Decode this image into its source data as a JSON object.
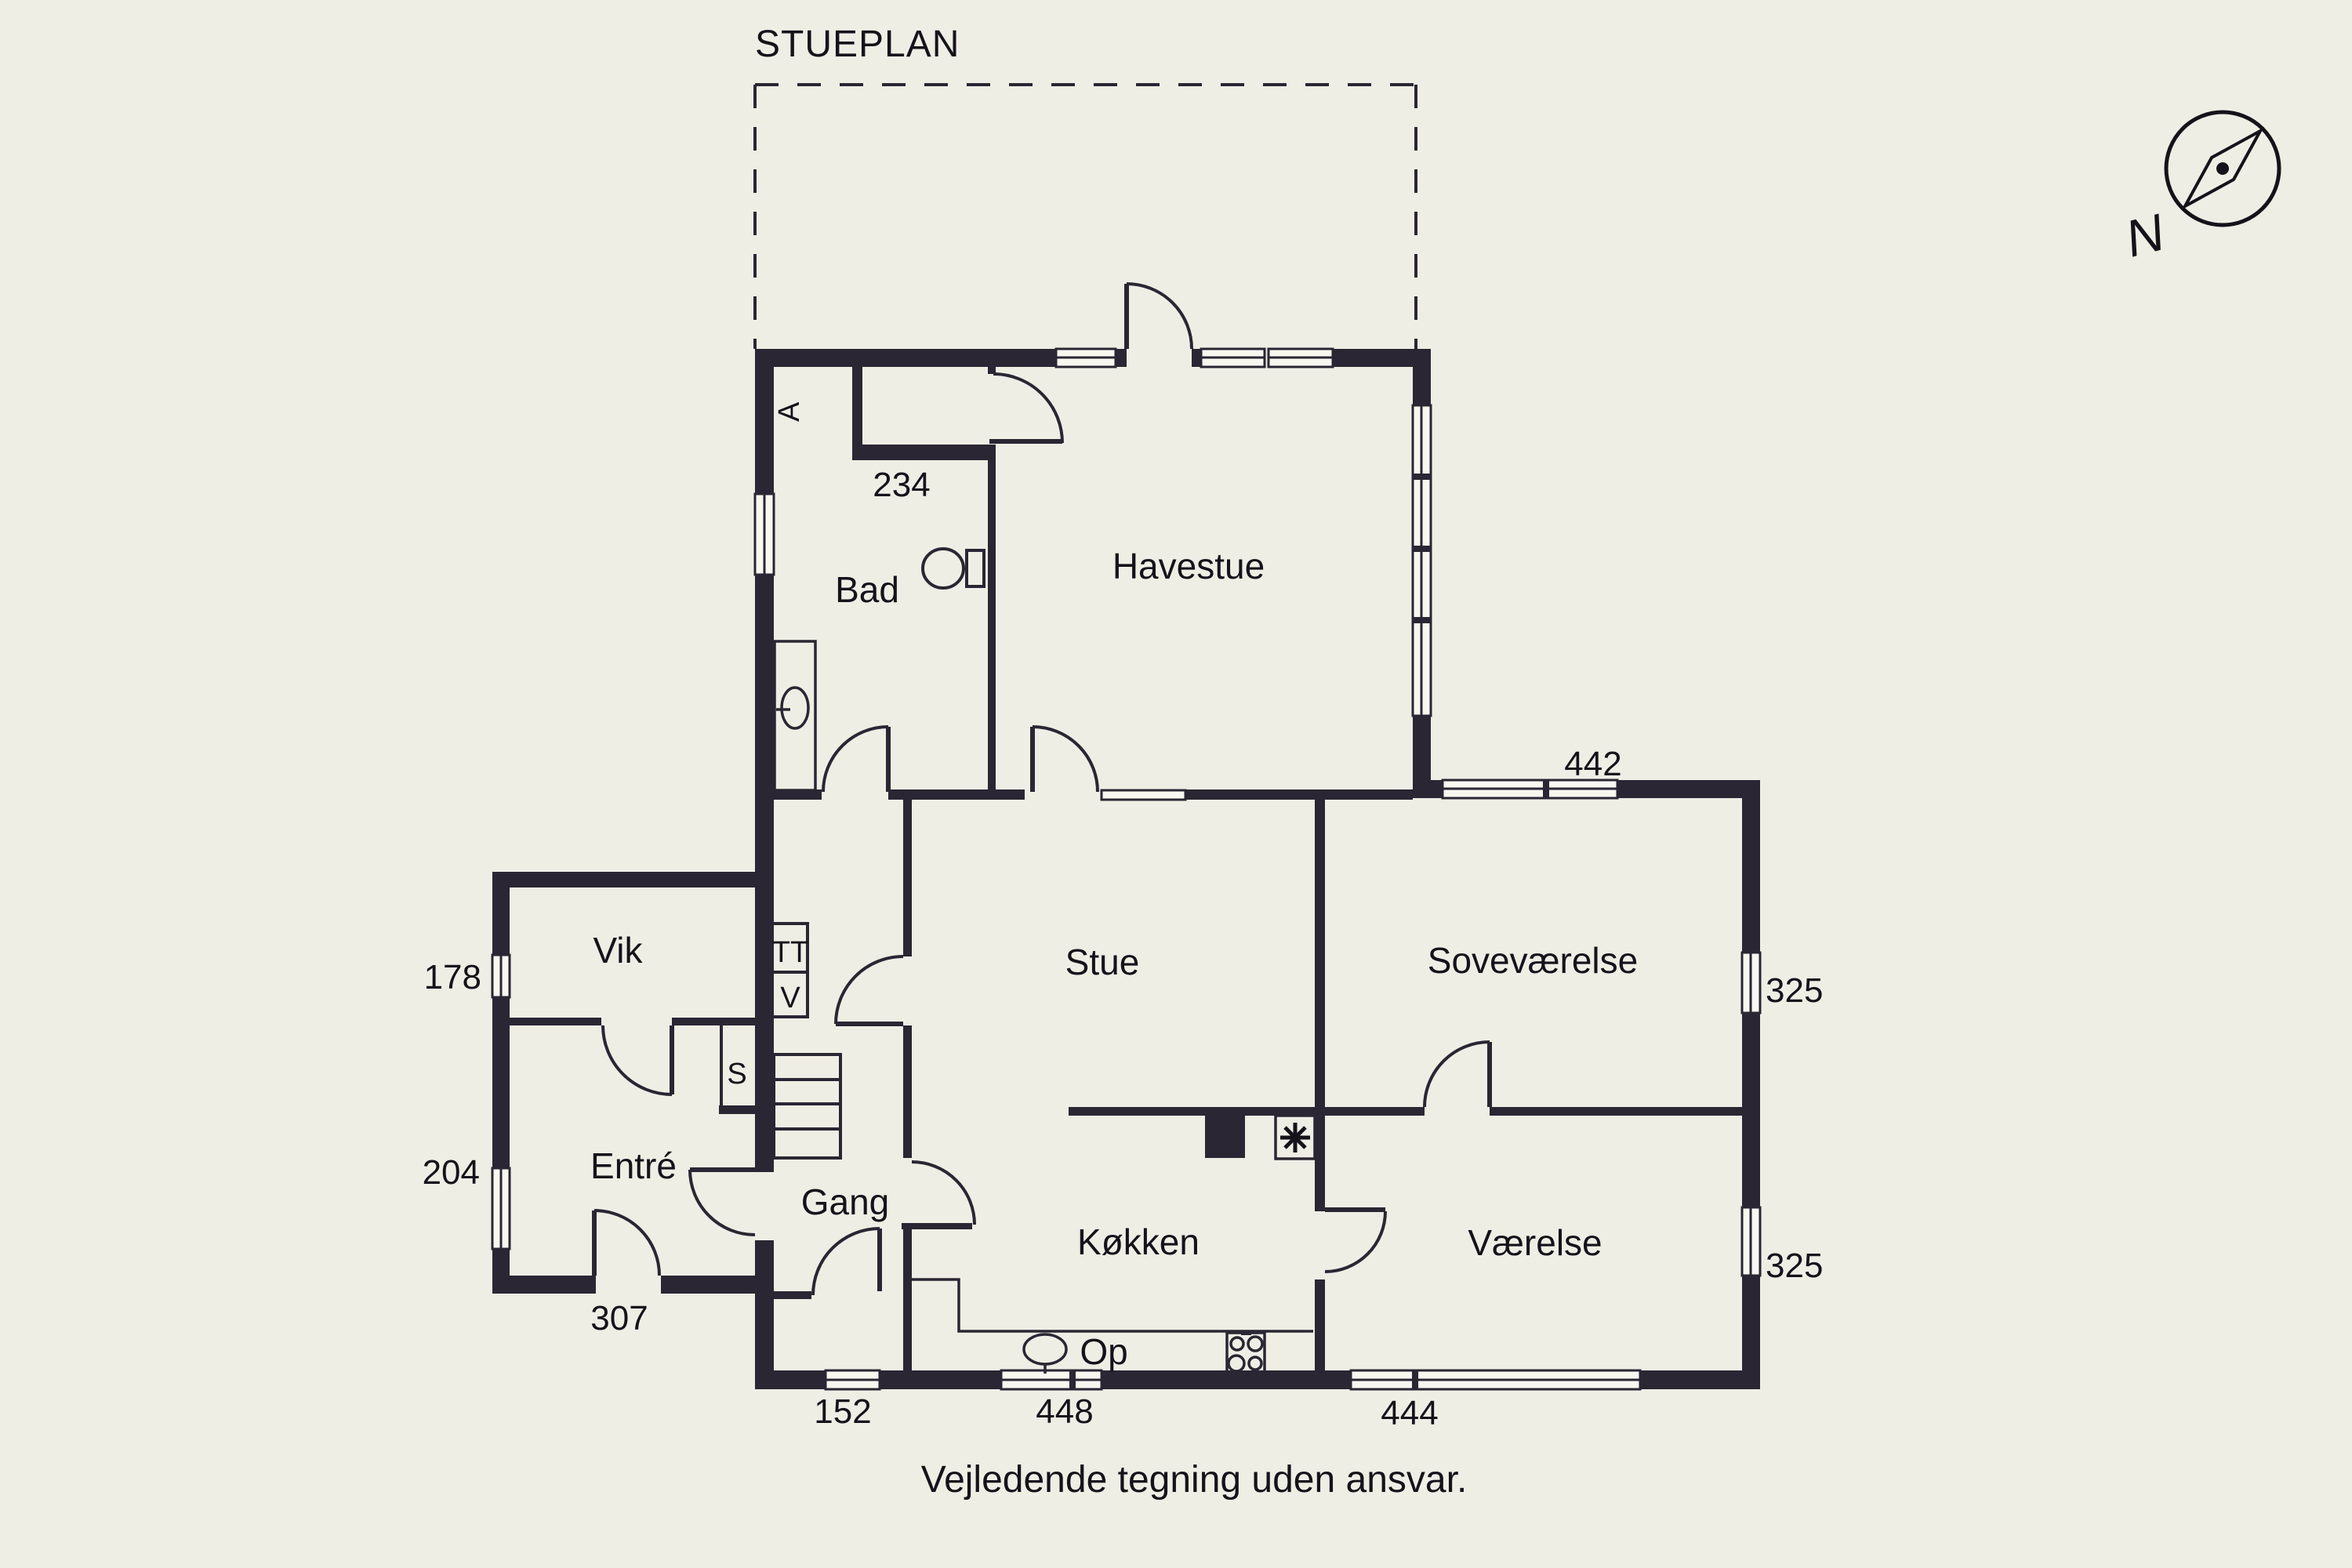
{
  "title": "STUEPLAN",
  "disclaimer": "Vejledende tegning uden ansvar.",
  "compass": {
    "north_label": "N"
  },
  "rooms": {
    "bad": "Bad",
    "havestue": "Havestue",
    "stue": "Stue",
    "sovevaerelse": "Soveværelse",
    "vik": "Vik",
    "entre": "Entré",
    "gang": "Gang",
    "koekken": "Køkken",
    "vaerelse": "Værelse"
  },
  "closets": {
    "s": "S",
    "tt": "TT",
    "v": "V"
  },
  "annotations": {
    "op": "Op",
    "attic_hatch": "A"
  },
  "dimensions": {
    "bad_niche": "234",
    "sovevaerelse_top": "442",
    "vik_left": "178",
    "entre_left": "204",
    "entre_bottom": "307",
    "gang_bottom": "152",
    "koekken_bottom": "448",
    "vaerelse_bottom": "444",
    "sovevaerelse_right": "325",
    "vaerelse_right": "325"
  },
  "colors": {
    "background": "#efeee5",
    "wall": "#2a2633",
    "text": "#15131a"
  }
}
